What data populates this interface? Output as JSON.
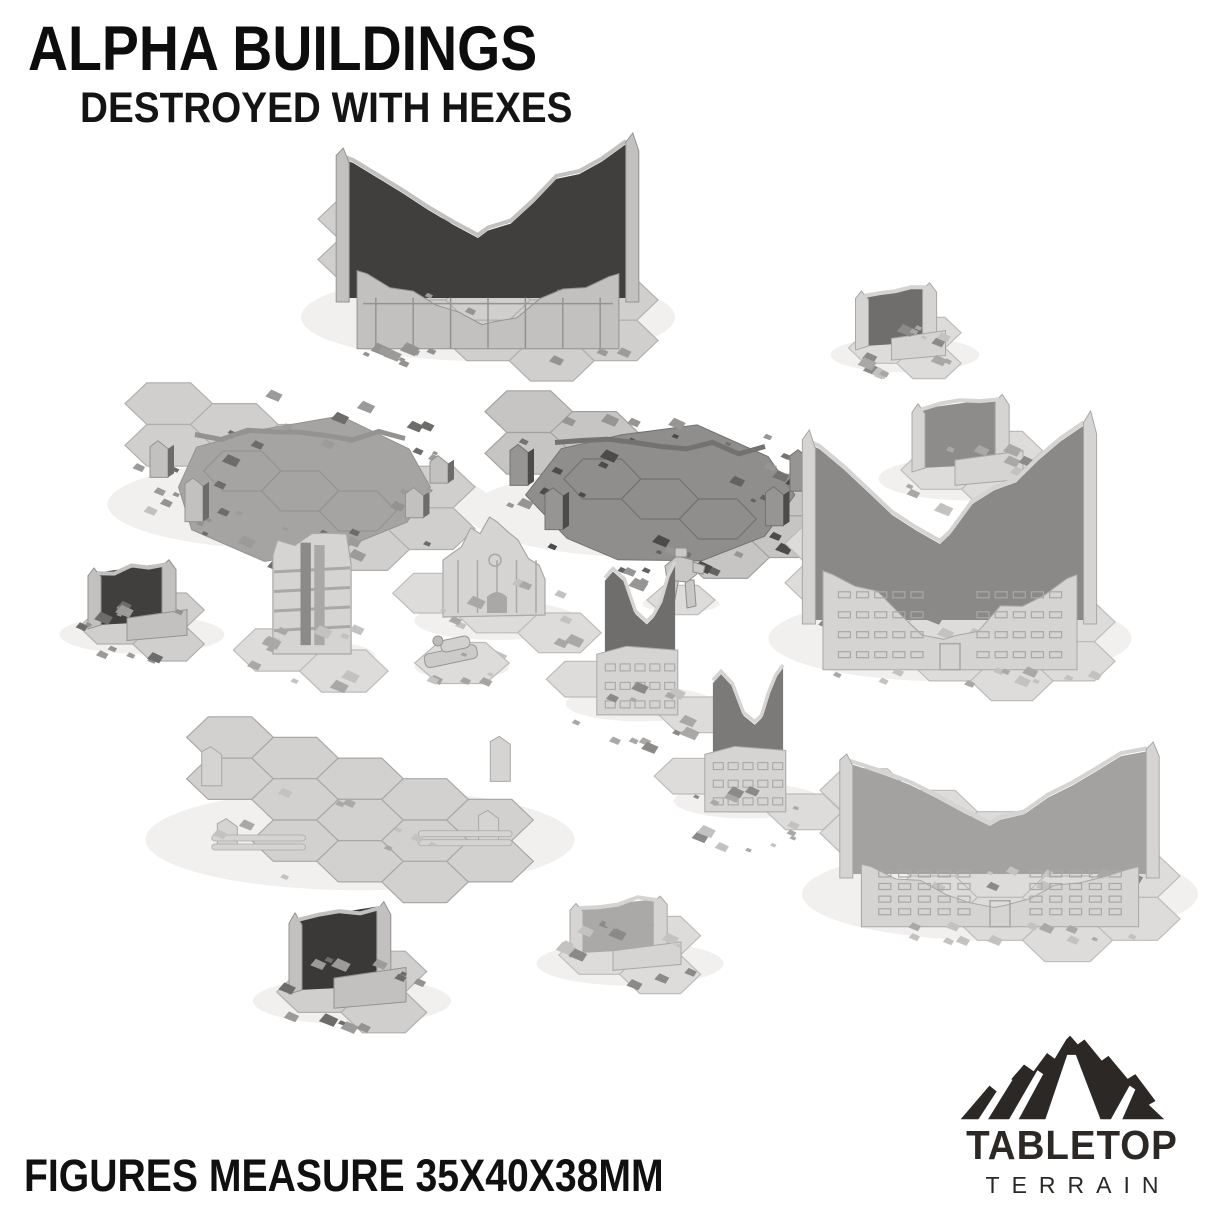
{
  "page": {
    "background": "#ffffff",
    "text_color": "#0d0d0d"
  },
  "header": {
    "title": "ALPHA BUILDINGS",
    "subtitle": "DESTROYED WITH HEXES"
  },
  "footer": {
    "caption": "FIGURES MEASURE 35X40X38MM"
  },
  "logo": {
    "icon": "mountain-icon",
    "line1": "TABLETOP",
    "line2": "TERRAIN",
    "color": "#2b2825"
  },
  "palette": {
    "tones": {
      "light": {
        "base": "#dddcda",
        "baseline": "#bdbcba",
        "wall": "#d5d4d2",
        "shade": "#a9a8a6",
        "interior": "#9a9997",
        "floor": "#d2d1cf",
        "rubble": "#c3c2c0",
        "dark": "#8b8a88"
      },
      "mid": {
        "base": "#d0cfcd",
        "baseline": "#b0afad",
        "wall": "#c2c1bf",
        "shade": "#949391",
        "interior": "#413f3e",
        "floor": "#a5a4a2",
        "rubble": "#9c9b99",
        "dark": "#6d6c6a"
      },
      "dark": {
        "base": "#c6c5c3",
        "baseline": "#a3a2a0",
        "wall": "#969593",
        "shade": "#737271",
        "interior": "#474645",
        "floor": "#8f8e8c",
        "rubble": "#636261",
        "dark": "#4c4b4a"
      }
    }
  },
  "scene": {
    "alt": "Grey 3D-rendered destroyed building terrain pieces on hexagonal bases, with one mech miniature for scale",
    "piece_count": 17,
    "pieces": [
      {
        "id": "ruin-large-top",
        "label": "large destroyed building with tall jagged walls",
        "type": "walled_ruin",
        "tone": "mid",
        "x": 488,
        "y": 300,
        "w": 340,
        "h": 150,
        "seed": 11
      },
      {
        "id": "ruin-small-top-right",
        "label": "small destroyed building",
        "type": "small_ruin",
        "tone": "light",
        "x": 905,
        "y": 348,
        "w": 135,
        "h": 62,
        "seed": 21,
        "interior": "#6f6e6d"
      },
      {
        "id": "foundation-left",
        "label": "ruined foundation with hex tile floor",
        "type": "foundation",
        "tone": "mid",
        "x": 300,
        "y": 487,
        "w": 350,
        "seed": 31
      },
      {
        "id": "foundation-center",
        "label": "ruined foundation with hex tile floor",
        "type": "foundation",
        "tone": "dark",
        "x": 660,
        "y": 495,
        "w": 350,
        "seed": 41
      },
      {
        "id": "ruin-small-right",
        "label": "small rubble-filled ruin",
        "type": "small_ruin",
        "tone": "light",
        "x": 972,
        "y": 470,
        "w": 170,
        "h": 72,
        "seed": 51,
        "interior": "#8d8c8a"
      },
      {
        "id": "building-large-right",
        "label": "large destroyed office building",
        "type": "walled_ruin",
        "tone": "light",
        "x": 950,
        "y": 622,
        "w": 330,
        "h": 190,
        "seed": 61,
        "facade": true,
        "interior": "#8a8987"
      },
      {
        "id": "ruin-small-left",
        "label": "small destroyed building with dark interior",
        "type": "small_ruin",
        "tone": "mid",
        "x": 142,
        "y": 627,
        "w": 150,
        "h": 64,
        "seed": 71
      },
      {
        "id": "tower-ruin-left",
        "label": "ruined multi-story tower block",
        "type": "tower",
        "tone": "light",
        "x": 312,
        "y": 650,
        "w": 115,
        "h": 122,
        "seed": 81
      },
      {
        "id": "cathedral-ruin",
        "label": "ruined ornate facade",
        "type": "cathedral",
        "tone": "light",
        "x": 497,
        "y": 613,
        "w": 150,
        "h": 96,
        "seed": 91
      },
      {
        "id": "wreck-walker",
        "label": "wrecked walker on hex base",
        "type": "vehicle",
        "tone": "light",
        "x": 462,
        "y": 663,
        "w": 86,
        "seed": 101
      },
      {
        "id": "mech-figure",
        "label": "mech miniature for scale",
        "type": "mech",
        "tone": "light",
        "x": 681,
        "y": 600,
        "w": 70,
        "seed": 111
      },
      {
        "id": "facade-tower-mid",
        "label": "ruined building facade with windows",
        "type": "facade_tower",
        "tone": "light",
        "x": 640,
        "y": 697,
        "w": 135,
        "h": 132,
        "seed": 121,
        "interior": "#6f6e6d"
      },
      {
        "id": "facade-tower-lower",
        "label": "ruined building facade with windows",
        "type": "facade_tower",
        "tone": "light",
        "x": 748,
        "y": 794,
        "w": 135,
        "h": 126,
        "seed": 131,
        "interior": "#7b7a79"
      },
      {
        "id": "platform-hex",
        "label": "flat hex-tiled platform ruin",
        "type": "platform",
        "tone": "light",
        "x": 360,
        "y": 820,
        "w": 390,
        "seed": 141
      },
      {
        "id": "ruin-large-bottom-right",
        "label": "large destroyed building",
        "type": "walled_ruin",
        "tone": "light",
        "x": 1000,
        "y": 876,
        "w": 360,
        "h": 120,
        "seed": 151,
        "facade": true,
        "interior": "#a3a2a0"
      },
      {
        "id": "ruin-small-bottom-left",
        "label": "small destroyed building with dark interior",
        "type": "small_ruin",
        "tone": "mid",
        "x": 352,
        "y": 992,
        "w": 180,
        "h": 86,
        "seed": 161,
        "interior": "#3a3938"
      },
      {
        "id": "ruin-small-bottom-center",
        "label": "small rubble-filled ruin",
        "type": "small_ruin",
        "tone": "light",
        "x": 630,
        "y": 955,
        "w": 170,
        "h": 56,
        "seed": 171,
        "interior": "#aaa9a7"
      }
    ]
  }
}
